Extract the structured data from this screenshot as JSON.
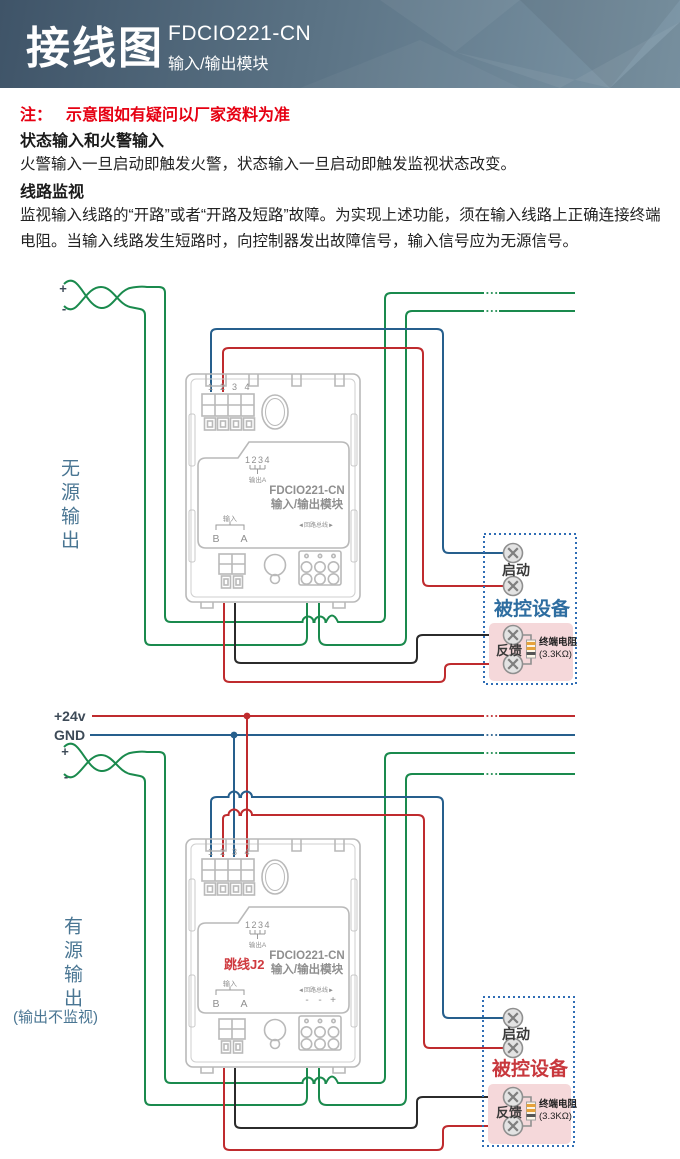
{
  "banner": {
    "title": "接线图",
    "model": "FDCIO221-CN",
    "subtitle": "输入/输出模块"
  },
  "note": {
    "label": "注：",
    "text": "示意图如有疑问以厂家资料为准"
  },
  "sections": [
    {
      "heading": "状态输入和火警输入",
      "body": "火警输入一旦启动即触发火警，状态输入一旦启动即触发监视状态改变。"
    },
    {
      "heading": "线路监视",
      "body": "监视输入线路的“开路”或者“开路及短路”故障。为实现上述功能，须在输入线路上正确连接终端电阻。当输入线路发生短路时，向控制器发出故障信号，输入信号应为无源信号。"
    }
  ],
  "diagram": {
    "labels": {
      "v24": "+24v",
      "gnd": "GND",
      "plus": "+",
      "minus": "-"
    },
    "module": {
      "terminal_numbers": [
        "1",
        "2",
        "3",
        "4"
      ],
      "output_ticks": "1234",
      "output_label": "输出A",
      "model": "FDCIO221-CN",
      "name": "输入/输出模块",
      "input_label": "输入",
      "input_b": "B",
      "input_a": "A",
      "loop_bus": "◄回路总线►"
    },
    "top": {
      "side_label": "无源输出",
      "device": {
        "title": "被控设备",
        "start": "启动",
        "feedback": "反馈",
        "resistor": "终端电阻",
        "resistor_value": "(3.3KΩ)"
      }
    },
    "bottom": {
      "side_label": "有源输出",
      "side_note": "(输出不监视)",
      "jumper": "跳线J2",
      "loop_polarity": [
        "-",
        "-",
        "+"
      ],
      "device": {
        "title": "被控设备",
        "start": "启动",
        "feedback": "反馈",
        "resistor": "终端电阻",
        "resistor_value": "(3.3KΩ)"
      }
    },
    "colors": {
      "wire_green": "#1a8a4d",
      "wire_red": "#bf2b2e",
      "wire_blue": "#265f8d",
      "wire_black": "#2b2b2b",
      "device_title_top": "#2e6da0",
      "device_title_bottom": "#c8383d",
      "module_outline": "#b9b9b9",
      "module_text": "#8f8f8f",
      "note_red": "#e60012",
      "side_label": "#4a7693"
    }
  }
}
